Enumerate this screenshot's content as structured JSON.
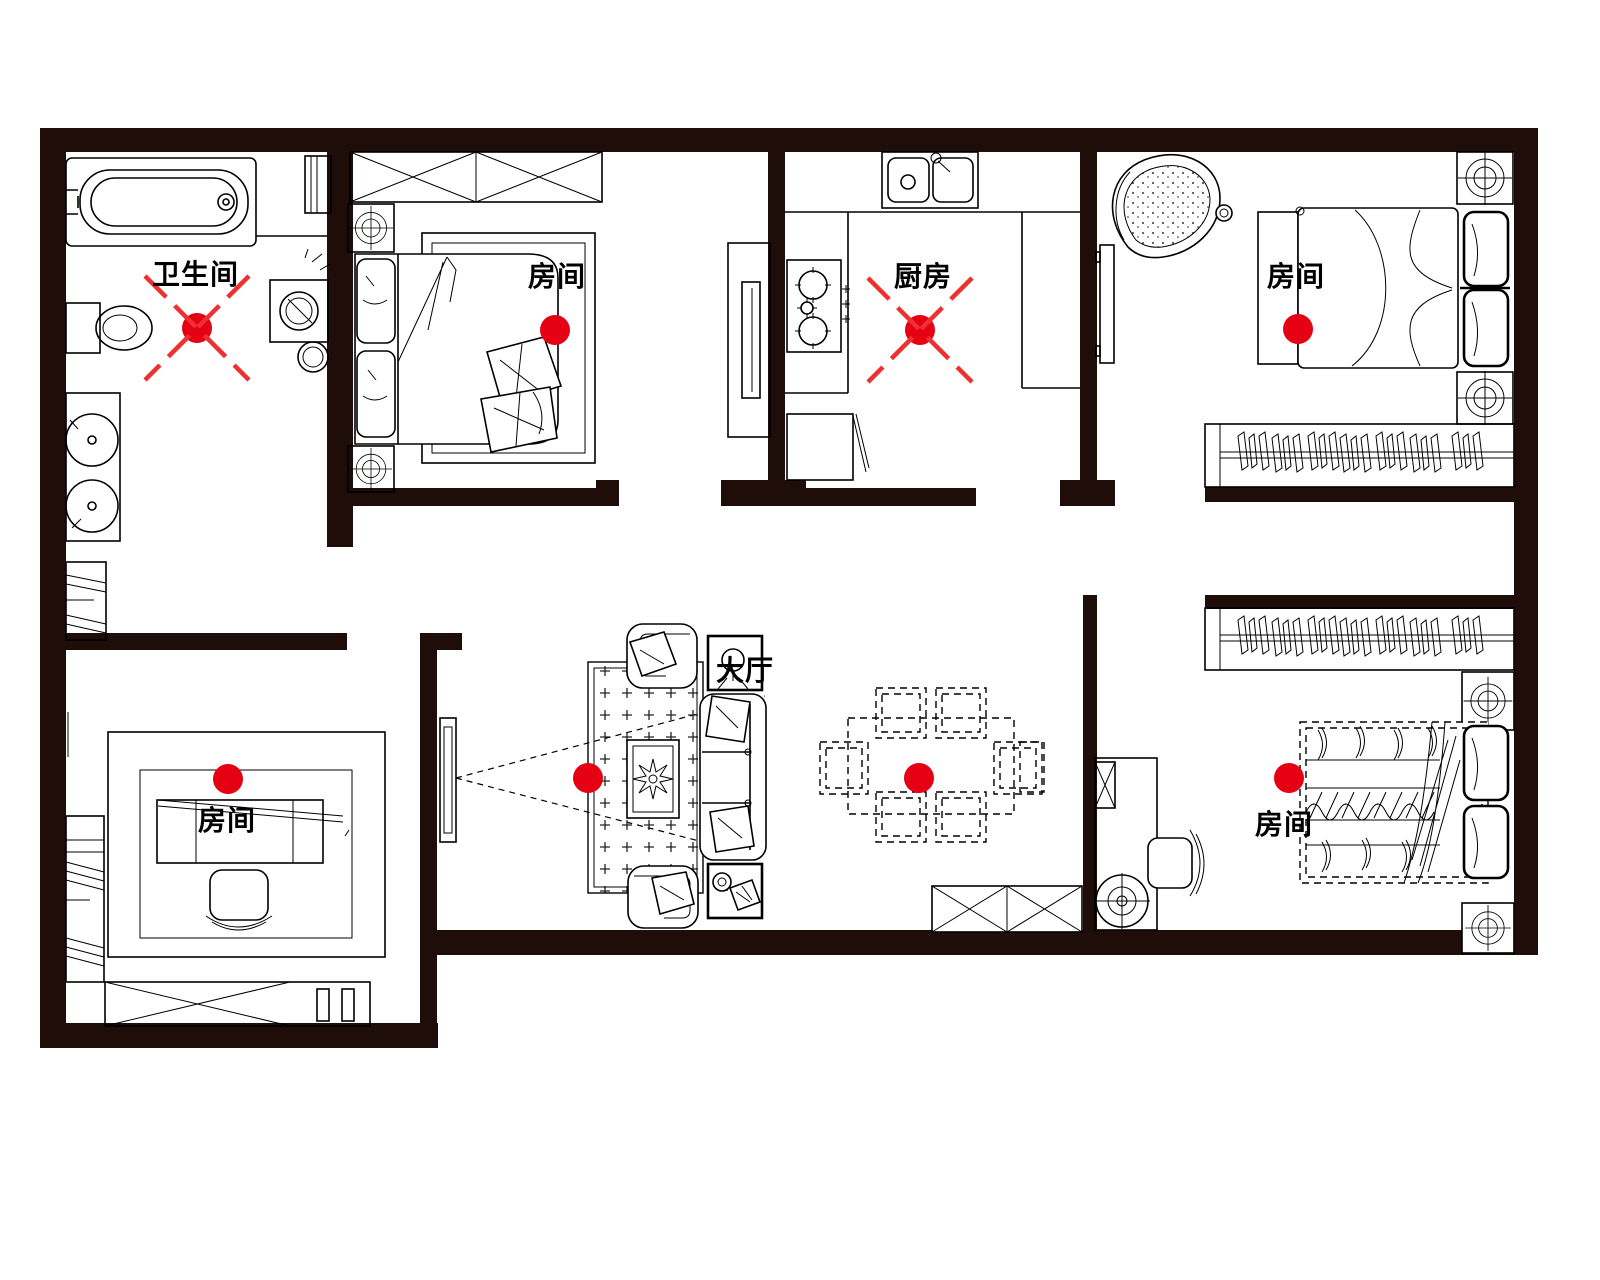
{
  "document": {
    "kind": "apartment-floor-plan",
    "language": "zh-CN",
    "canvas": {
      "width": 1600,
      "height": 1280
    }
  },
  "colors": {
    "background": "#ffffff",
    "wall": "#1e0d09",
    "line": "#000000",
    "marker": "#e60014",
    "marker_cross": "#ee3030"
  },
  "rooms": [
    {
      "id": "bathroom",
      "label": "卫生间",
      "marker": {
        "x": 197,
        "y": 328
      },
      "marker_crossed": true
    },
    {
      "id": "bedroom-top-left",
      "label": "房间",
      "marker": {
        "x": 555,
        "y": 330
      },
      "marker_crossed": false
    },
    {
      "id": "kitchen",
      "label": "厨房",
      "marker": {
        "x": 920,
        "y": 330
      },
      "marker_crossed": true
    },
    {
      "id": "bedroom-top-right",
      "label": "房间",
      "marker": {
        "x": 1298,
        "y": 329
      },
      "marker_crossed": false
    },
    {
      "id": "room-bottom-left",
      "label": "房间",
      "marker": {
        "x": 228,
        "y": 779
      },
      "marker_crossed": false
    },
    {
      "id": "living-hall",
      "label": "大厅",
      "marker": {
        "x": 588,
        "y": 778
      },
      "marker_crossed": false
    },
    {
      "id": "dining-area",
      "label": "",
      "marker": {
        "x": 919,
        "y": 778
      },
      "marker_crossed": false
    },
    {
      "id": "bedroom-bottom-right",
      "label": "房间",
      "marker": {
        "x": 1289,
        "y": 778
      },
      "marker_crossed": false
    }
  ],
  "furniture": [
    "bathtub",
    "toilet",
    "washing-machine",
    "double-vanity-sinks",
    "radiator",
    "wardrobe-x2-bedroom1",
    "double-bed-bedroom1",
    "nightstands-bedroom1",
    "kitchen-sink",
    "stove",
    "refrigerator",
    "counters",
    "lounge-chair",
    "wall-tv",
    "double-bed-bedroom2",
    "hanging-wardrobes",
    "desk-dressing-table",
    "desk-chair",
    "shelf-unit",
    "low-cabinet",
    "tv",
    "tv-viewing-cone",
    "carpet",
    "sofa-3seat",
    "armchairs",
    "coffee-table-plant",
    "lamp-side-table",
    "telephone-side-table",
    "dining-table-6-chairs",
    "console-cabinet",
    "desk-bedroom4",
    "office-chair",
    "floor-fan",
    "double-bed-bedroom4",
    "nightstand-lamps"
  ]
}
